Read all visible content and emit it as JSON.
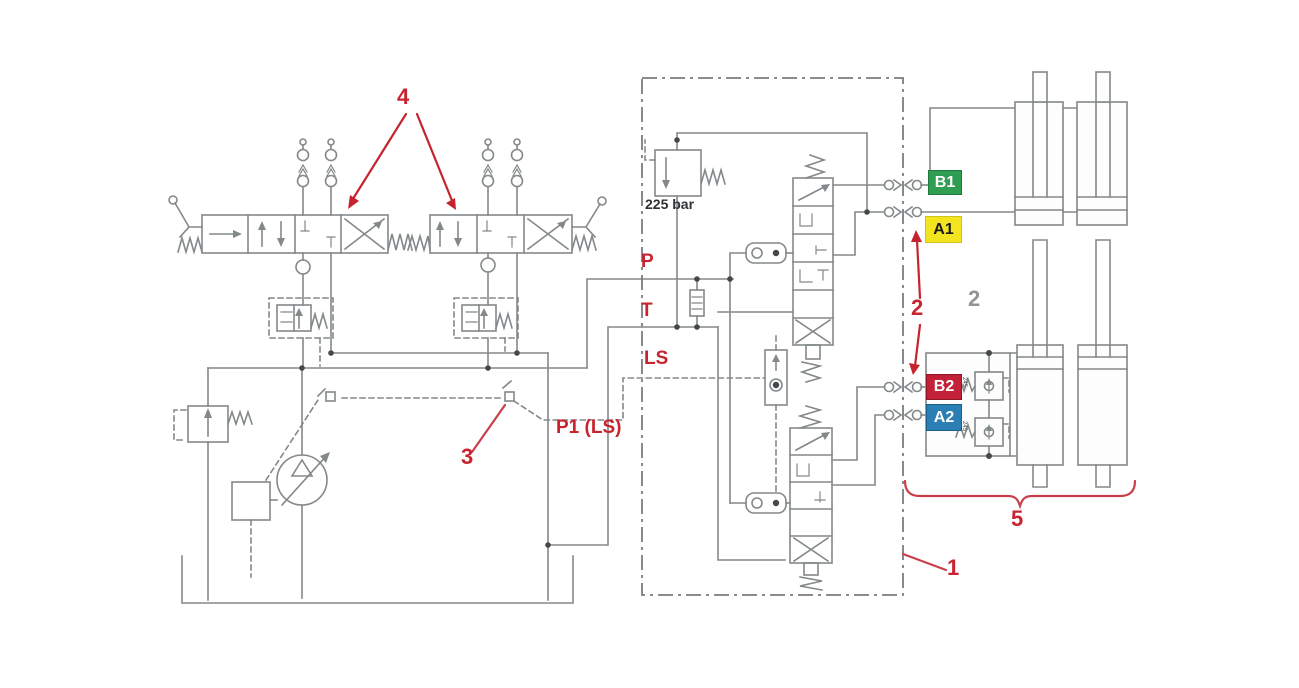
{
  "labels": {
    "pressure_setting": "225 bar",
    "port_p": "P",
    "port_t": "T",
    "port_ls": "LS",
    "port_p1_ls": "P1 (LS)"
  },
  "callouts": {
    "valve_block": "1",
    "couplings": "2",
    "couplings_gray": "2",
    "ls_coupling": "3",
    "control_valves": "4",
    "cylinder_group": "5"
  },
  "ports": [
    {
      "label": "B1",
      "bg": "#2f9e53",
      "fg": "#ffffff",
      "border": "#1d7a3c"
    },
    {
      "label": "A1",
      "bg": "#f2e41e",
      "fg": "#1a1a1a",
      "border": "#cfc417"
    },
    {
      "label": "B2",
      "bg": "#c32138",
      "fg": "#ffffff",
      "border": "#8f1626"
    },
    {
      "label": "A2",
      "bg": "#2b7fb4",
      "fg": "#ffffff",
      "border": "#1c5f8a"
    }
  ],
  "shock_valve_settings": [
    "245",
    "245"
  ],
  "colors": {
    "callout_red": "#c5242e",
    "leader_red": "#c9404c",
    "line_gray": "#83888a",
    "background": "#ffffff"
  }
}
